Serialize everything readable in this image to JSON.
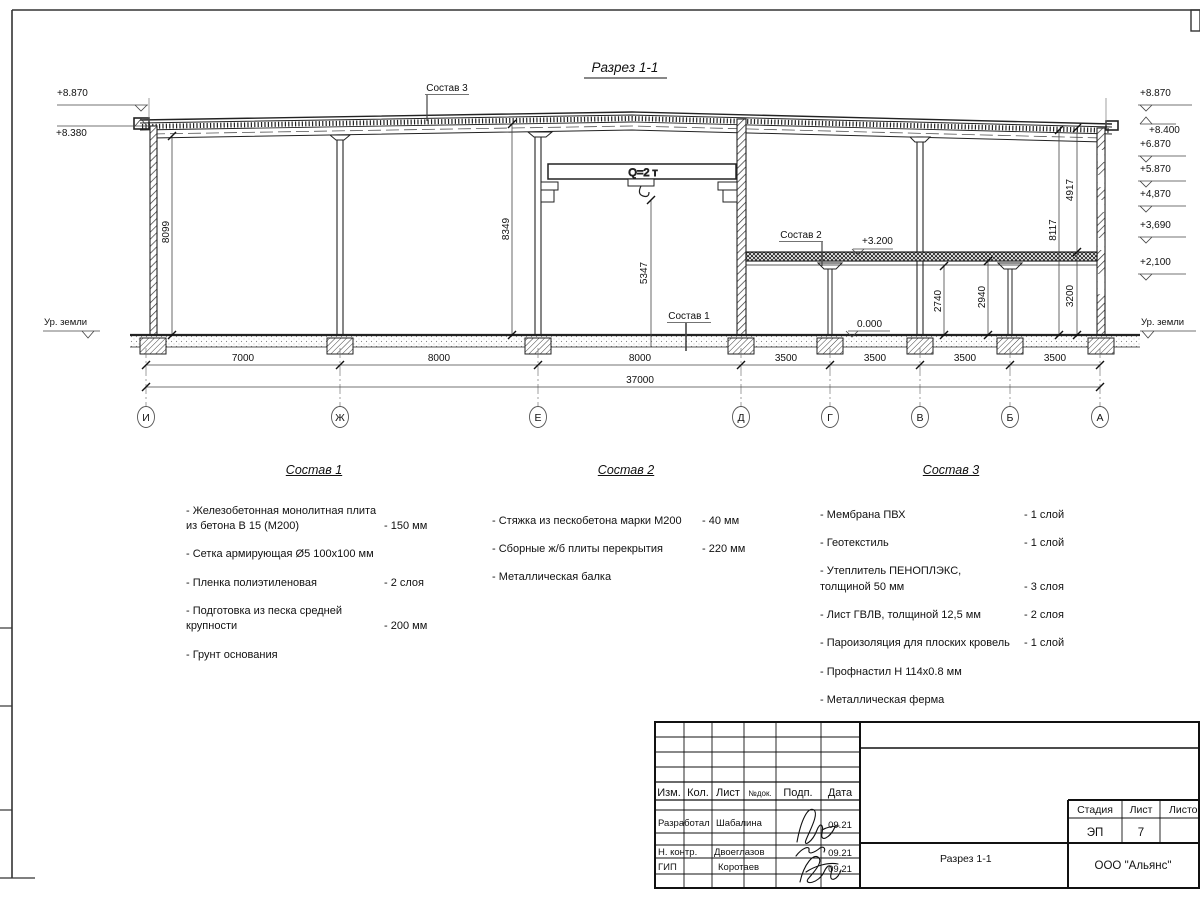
{
  "section": {
    "title": "Разрез 1-1",
    "crane": "Q=2 т",
    "ground_left": "Ур. земли",
    "ground_right": "Ур. земли",
    "label_sostav1": "Состав 1",
    "label_sostav2": "Состав 2",
    "label_sostav3": "Состав 3",
    "elev": {
      "l1": "+8.870",
      "l2": "+8.380",
      "r1": "+8.870",
      "r2": "+8.400",
      "r3": "+6.870",
      "r4": "+5.870",
      "r5": "+4,870",
      "r6": "+3,690",
      "r7": "+2,100",
      "floor": "+3.200",
      "zero": "0.000"
    },
    "vdim": {
      "d8099": "8099",
      "d8349": "8349",
      "d5347": "5347",
      "d2740": "2740",
      "d2940": "2940",
      "d3200": "3200",
      "d8117": "8117",
      "d4917": "4917"
    },
    "hdims": [
      "7000",
      "8000",
      "8000",
      "3500",
      "3500",
      "3500",
      "3500"
    ],
    "total": "37000",
    "axes": [
      "И",
      "Ж",
      "Е",
      "Д",
      "Г",
      "В",
      "Б",
      "А"
    ]
  },
  "compositions": [
    {
      "title": "Состав 1",
      "items": [
        {
          "text": "- Железобетонная  монолитная плита\n  из бетона В 15 (М200)",
          "value": "- 150 мм"
        },
        {
          "text": "- Сетка армирующая Ø5 100х100 мм",
          "value": ""
        },
        {
          "text": "- Пленка полиэтиленовая",
          "value": "-  2 слоя"
        },
        {
          "text": "- Подготовка из песка средней\n  крупности",
          "value": "- 200 мм"
        },
        {
          "text": "- Грунт основания",
          "value": ""
        }
      ]
    },
    {
      "title": "Состав 2",
      "items": [
        {
          "text": "- Стяжка из пескобетона марки М200",
          "value": "- 40 мм"
        },
        {
          "text": "- Сборные ж/б плиты перекрытия",
          "value": "- 220 мм"
        },
        {
          "text": "- Металлическая балка",
          "value": ""
        }
      ]
    },
    {
      "title": "Состав 3",
      "items": [
        {
          "text": "- Мембрана ПВХ",
          "value": "- 1 слой"
        },
        {
          "text": "- Геотекстиль",
          "value": "- 1 слой"
        },
        {
          "text": "- Утеплитель ПЕНОПЛЭКС,\n  толщиной 50 мм",
          "value": "- 3 слоя"
        },
        {
          "text": "- Лист ГВЛВ, толщиной 12,5 мм",
          "value": "- 2 слоя"
        },
        {
          "text": "- Пароизоляция для плоских кровель",
          "value": "- 1 слой"
        },
        {
          "text": "- Профнастил Н 114х0.8 мм",
          "value": ""
        },
        {
          "text": "- Металлическая ферма",
          "value": ""
        }
      ]
    }
  ],
  "title_block": {
    "col_izm": "Изм.",
    "col_kol": "Кол.",
    "col_list": "Лист",
    "col_ndok": "№док.",
    "col_podp": "Подп.",
    "col_data": "Дата",
    "rows": [
      {
        "role": "Разработал",
        "name": "Шабалина",
        "date": "09.21"
      },
      {
        "role": "Н. контр.",
        "name": "Двоеглазов",
        "date": "09.21"
      },
      {
        "role": "ГИП",
        "name": "Коротаев",
        "date": "09.21"
      }
    ],
    "stage_label": "Стадия",
    "list_label": "Лист",
    "listov_label": "Листов",
    "stage": "ЭП",
    "list_no": "7",
    "doc_name": "Разрез 1-1",
    "company": "ООО \"Альянс\""
  }
}
